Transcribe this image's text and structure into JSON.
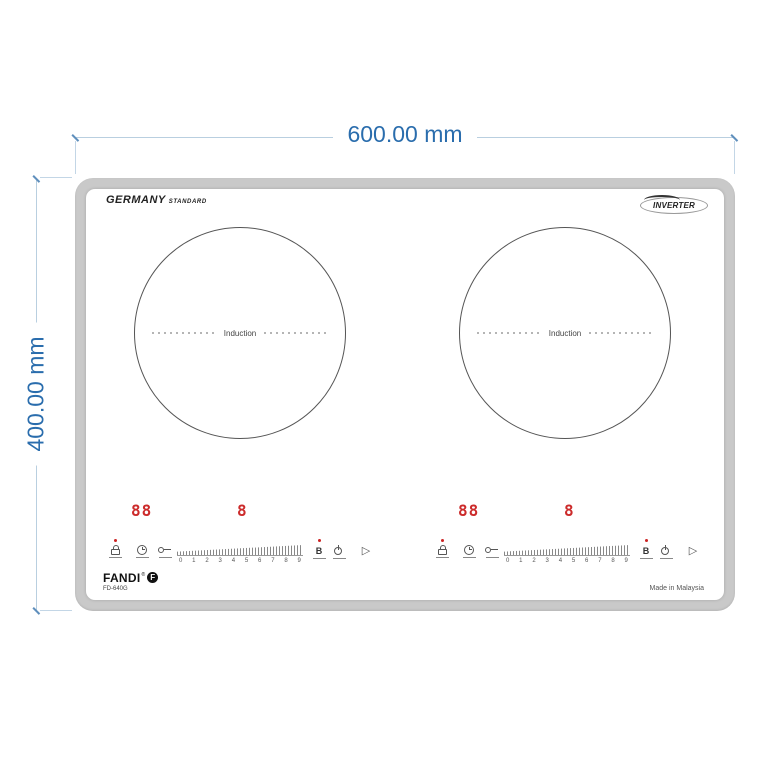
{
  "dimensions": {
    "width_label": "600.00 mm",
    "height_label": "400.00 mm",
    "text_color": "#2a6dad",
    "line_color": "#b9cfe0"
  },
  "cooktop": {
    "frame_color": "#c9c9c9",
    "display_color": "#cc2b2b",
    "led_color": "#cc2222",
    "top_left_brand": {
      "primary": "GERMANY",
      "secondary": "STANDARD"
    },
    "top_right_badge": "INVERTER",
    "zones": [
      {
        "label": "Induction"
      },
      {
        "label": "Induction"
      }
    ],
    "control_units": [
      {
        "display_main": "88",
        "display_secondary": "8",
        "booster_label": "B",
        "play_glyph": "▷",
        "slider_numbers": [
          "0",
          "1",
          "2",
          "3",
          "4",
          "5",
          "6",
          "7",
          "8",
          "9"
        ]
      },
      {
        "display_main": "88",
        "display_secondary": "8",
        "booster_label": "B",
        "play_glyph": "▷",
        "slider_numbers": [
          "0",
          "1",
          "2",
          "3",
          "4",
          "5",
          "6",
          "7",
          "8",
          "9"
        ]
      }
    ],
    "bottom_brand": {
      "name": "FANDI",
      "reg": "®",
      "mark_letter": "F",
      "model": "FD-640G"
    },
    "made_in": "Made in Malaysia"
  }
}
